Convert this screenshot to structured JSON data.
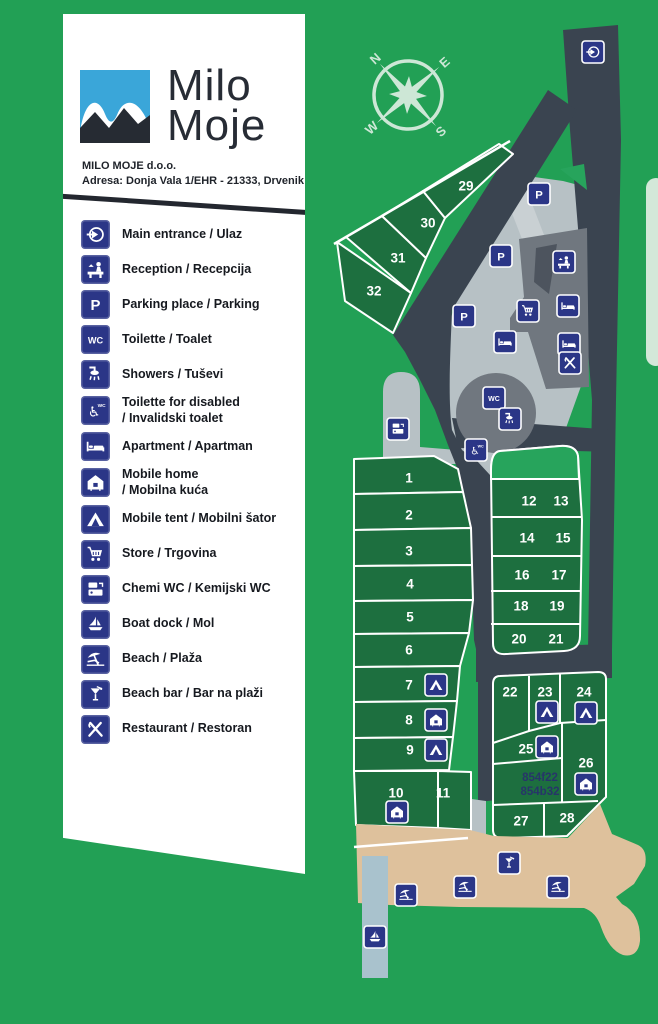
{
  "panel": {
    "logo": {
      "line1": "Milo",
      "line2": "Moje"
    },
    "company": "MILO MOJE d.o.o.",
    "address": "Adresa: Donja Vala 1/EHR - 21333, Drvenik"
  },
  "legend": {
    "items": [
      {
        "icon": "main-entrance",
        "label": "Main entrance / Ulaz"
      },
      {
        "icon": "reception",
        "label": "Reception / Recepcija"
      },
      {
        "icon": "parking",
        "label": "Parking place / Parking"
      },
      {
        "icon": "wc",
        "label": "Toilette / Toalet"
      },
      {
        "icon": "shower",
        "label": "Showers / Tuševi"
      },
      {
        "icon": "disabled-wc",
        "label": "Toilette for disabled\n/ Invalidski toalet"
      },
      {
        "icon": "apartment",
        "label": "Apartment / Apartman"
      },
      {
        "icon": "mobile-home",
        "label": "Mobile home\n/ Mobilna kuća"
      },
      {
        "icon": "mobile-tent",
        "label": "Mobile tent / Mobilni šator"
      },
      {
        "icon": "store",
        "label": "Store / Trgovina"
      },
      {
        "icon": "chemi-wc",
        "label": "Chemi WC / Kemijski WC"
      },
      {
        "icon": "boat-dock",
        "label": "Boat dock / Mol"
      },
      {
        "icon": "beach",
        "label": "Beach / Plaža"
      },
      {
        "icon": "beach-bar",
        "label": "Beach bar / Bar na plaži"
      },
      {
        "icon": "restaurant",
        "label": "Restaurant / Restoran"
      }
    ]
  },
  "compass": {
    "n": "N",
    "e": "E",
    "s": "S",
    "w": "W"
  },
  "map": {
    "plot_labels": [
      {
        "text": "1",
        "x": 409,
        "y": 478
      },
      {
        "text": "2",
        "x": 409,
        "y": 515
      },
      {
        "text": "3",
        "x": 409,
        "y": 551
      },
      {
        "text": "4",
        "x": 410,
        "y": 584
      },
      {
        "text": "5",
        "x": 410,
        "y": 617
      },
      {
        "text": "6",
        "x": 409,
        "y": 650
      },
      {
        "text": "7",
        "x": 409,
        "y": 685
      },
      {
        "text": "8",
        "x": 409,
        "y": 720
      },
      {
        "text": "9",
        "x": 410,
        "y": 750
      },
      {
        "text": "10",
        "x": 396,
        "y": 793
      },
      {
        "text": "11",
        "x": 443,
        "y": 793
      },
      {
        "text": "12",
        "x": 529,
        "y": 501
      },
      {
        "text": "13",
        "x": 561,
        "y": 501
      },
      {
        "text": "14",
        "x": 527,
        "y": 538
      },
      {
        "text": "15",
        "x": 563,
        "y": 538
      },
      {
        "text": "16",
        "x": 522,
        "y": 575
      },
      {
        "text": "17",
        "x": 559,
        "y": 575
      },
      {
        "text": "18",
        "x": 521,
        "y": 606
      },
      {
        "text": "19",
        "x": 557,
        "y": 606
      },
      {
        "text": "20",
        "x": 519,
        "y": 639
      },
      {
        "text": "21",
        "x": 556,
        "y": 639
      },
      {
        "text": "22",
        "x": 510,
        "y": 692
      },
      {
        "text": "23",
        "x": 545,
        "y": 692
      },
      {
        "text": "24",
        "x": 584,
        "y": 692
      },
      {
        "text": "25",
        "x": 526,
        "y": 749
      },
      {
        "text": "26",
        "x": 586,
        "y": 763
      },
      {
        "text": "27",
        "x": 521,
        "y": 821
      },
      {
        "text": "28",
        "x": 567,
        "y": 818
      },
      {
        "text": "29",
        "x": 466,
        "y": 186
      },
      {
        "text": "30",
        "x": 428,
        "y": 223
      },
      {
        "text": "31",
        "x": 398,
        "y": 258
      },
      {
        "text": "32",
        "x": 374,
        "y": 291
      }
    ],
    "special_labels": [
      {
        "text": "854f22",
        "x": 540,
        "y": 778
      },
      {
        "text": "854b32",
        "x": 540,
        "y": 792
      }
    ],
    "markers": [
      {
        "icon": "main-entrance",
        "x": 593,
        "y": 52
      },
      {
        "icon": "parking",
        "x": 539,
        "y": 194
      },
      {
        "icon": "parking",
        "x": 501,
        "y": 256
      },
      {
        "icon": "parking",
        "x": 464,
        "y": 316
      },
      {
        "icon": "reception",
        "x": 564,
        "y": 262
      },
      {
        "icon": "store",
        "x": 528,
        "y": 311
      },
      {
        "icon": "apartment",
        "x": 568,
        "y": 306
      },
      {
        "icon": "apartment",
        "x": 505,
        "y": 342
      },
      {
        "icon": "apartment",
        "x": 569,
        "y": 344
      },
      {
        "icon": "restaurant",
        "x": 570,
        "y": 363
      },
      {
        "icon": "wc",
        "x": 494,
        "y": 398
      },
      {
        "icon": "shower",
        "x": 510,
        "y": 419
      },
      {
        "icon": "disabled-wc",
        "x": 476,
        "y": 450
      },
      {
        "icon": "chemi-wc",
        "x": 398,
        "y": 429
      },
      {
        "icon": "mobile-tent",
        "x": 436,
        "y": 685
      },
      {
        "icon": "mobile-home",
        "x": 436,
        "y": 720
      },
      {
        "icon": "mobile-tent",
        "x": 436,
        "y": 750
      },
      {
        "icon": "mobile-home",
        "x": 397,
        "y": 812
      },
      {
        "icon": "mobile-tent",
        "x": 547,
        "y": 712
      },
      {
        "icon": "mobile-tent",
        "x": 586,
        "y": 713
      },
      {
        "icon": "mobile-home",
        "x": 547,
        "y": 747
      },
      {
        "icon": "mobile-home",
        "x": 586,
        "y": 784
      },
      {
        "icon": "beach-bar",
        "x": 509,
        "y": 863
      },
      {
        "icon": "beach",
        "x": 406,
        "y": 895
      },
      {
        "icon": "beach",
        "x": 465,
        "y": 887
      },
      {
        "icon": "beach",
        "x": 558,
        "y": 887
      },
      {
        "icon": "boat-dock",
        "x": 375,
        "y": 937
      }
    ]
  },
  "colors": {
    "background": "#22a055",
    "plot_green": "#1d6f3f",
    "road": "#3a4450",
    "sign_blue": "#2b3687",
    "sand": "#dec19c",
    "dock": "#a9c2cd"
  }
}
